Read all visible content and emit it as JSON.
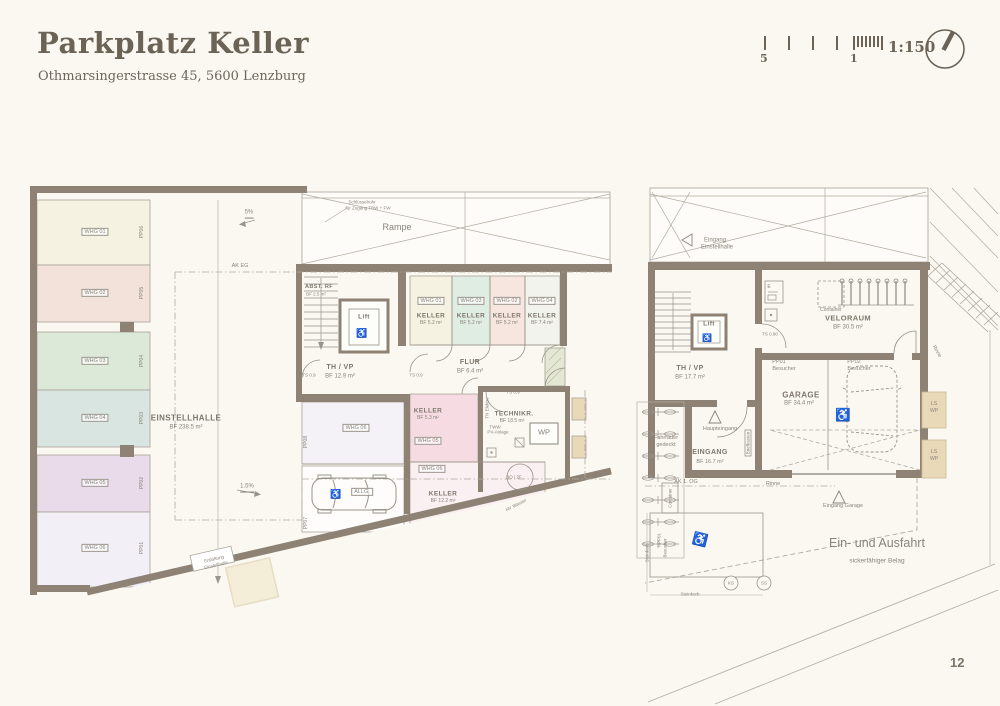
{
  "header": {
    "title": "Parkplatz Keller",
    "subtitle": "Othmarsingerstrasse 45, 5600 Lenzburg",
    "scale": "1:150",
    "tick5": "5",
    "tick1": "1"
  },
  "page": {
    "number": "12"
  },
  "icons": {
    "wheelchair": "♿"
  },
  "colors": {
    "wall": "#8d8274",
    "paper": "#fbf8f2",
    "stall_whg01": "#f6f2e1",
    "stall_whg02": "#f2e2da",
    "stall_whg03": "#dde9d8",
    "stall_whg04": "#d9e5e1",
    "stall_whg05": "#e9dbe9",
    "stall_whg06": "#f2f0f6",
    "keller_whg01": "#f6f2e1",
    "keller_whg03": "#e0ede2",
    "keller_whg02": "#f7e5df",
    "keller_whg04": "#f3f3ee",
    "keller_whg05": "#f6dce2",
    "keller_whg06": "#faeff1",
    "hatch_green": "#e3e7d3",
    "shaft_tan": "#e9d9b8",
    "beige_pad": "#f4edd8"
  },
  "left": {
    "stalls": [
      {
        "whg": "WHG 01",
        "pp": "PP06"
      },
      {
        "whg": "WHG 02",
        "pp": "PP05"
      },
      {
        "whg": "WHG 03",
        "pp": "PP04"
      },
      {
        "whg": "WHG 04",
        "pp": "PP03"
      },
      {
        "whg": "WHG 05",
        "pp": "PP02"
      },
      {
        "whg": "WHG 06",
        "pp": "PP01"
      }
    ],
    "hall": {
      "name": "EINSTELLHALLE",
      "area": "BF 238.5 m²"
    },
    "slope_top": "5%",
    "slope_mid": "1.5%",
    "ak_eg": "AK EG",
    "ramp": {
      "label": "Rampe",
      "note1": "Schlüsselrohr",
      "note2": "für Zugang TBW + FW"
    },
    "abst": {
      "name": "ABST. RF",
      "area": "BF 2.5 m²"
    },
    "lift": "Lift",
    "thvp": {
      "name": "TH / VP",
      "area": "BF 12.9 m²"
    },
    "flur": {
      "name": "FLUR",
      "area": "BF 6.4 m²"
    },
    "kellers": [
      {
        "whg": "WHG 01",
        "name": "KELLER",
        "area": "BF 5.2 m²"
      },
      {
        "whg": "WHG 03",
        "name": "KELLER",
        "area": "BF 5.2 m²"
      },
      {
        "whg": "WHG 02",
        "name": "KELLER",
        "area": "BF 5.2 m²"
      },
      {
        "whg": "WHG 04",
        "name": "KELLER",
        "area": "BF 7.4 m²"
      }
    ],
    "mid": {
      "whg": "WHG 06",
      "pp": "PP08"
    },
    "allg": {
      "label": "ALLG.",
      "pp": "PP07"
    },
    "k5": {
      "name": "KELLER",
      "area": "BF 5.3 m²",
      "whg": "WHG 05"
    },
    "k12": {
      "whg": "WHG 06",
      "name": "KELLER",
      "area": "BF 12.2 m²"
    },
    "tech": {
      "name": "TECHNIKR.",
      "area": "BF 18.5 m²",
      "wp": "WP",
      "bo": "BO / 2F",
      "elektro": "TN Elektro",
      "pv1": "TWW",
      "pv2": "PV-Anlage",
      "wasser": "HV Wasser"
    },
    "ts": "TS 0.9",
    "vent1": "Entlüftung",
    "vent2": "Einstellhalle"
  },
  "right": {
    "entry1": "Eingang",
    "entry2": "Einstellhalle",
    "container": "Container",
    "e": "E",
    "velo": {
      "name": "VELORAUM",
      "area": "BF 30.5 m²"
    },
    "lift": "Lift",
    "thvp": {
      "name": "TH / VP",
      "area": "BF 17.7 m²"
    },
    "ts": "TS 0.90",
    "garage": {
      "pp1": "PP01",
      "pp1b": "Besucher",
      "pp2": "PP02",
      "pp2b": "Besucher",
      "name": "GARAGE",
      "area": "BF 34.4 m²"
    },
    "ls": "LS",
    "wp": "WP",
    "rinne": "Rinne",
    "bikes1": "Fahrräder",
    "bikes2": "gedeckt",
    "haupt": "Haupteingang",
    "eingang": {
      "name": "EINGANG",
      "area": "BF 16.7 m²"
    },
    "brief": "Briefkasten",
    "akog": "AK 1. OG",
    "eingarage": "Eingang Garage",
    "ausfahrt": "Ein- und Ausfahrt",
    "belag": "sickerfähiger Belag",
    "app1": "APP01",
    "app2": "Besucher",
    "ks": "KS",
    "ss": "SS",
    "steinkorb": "Steinkorb"
  }
}
